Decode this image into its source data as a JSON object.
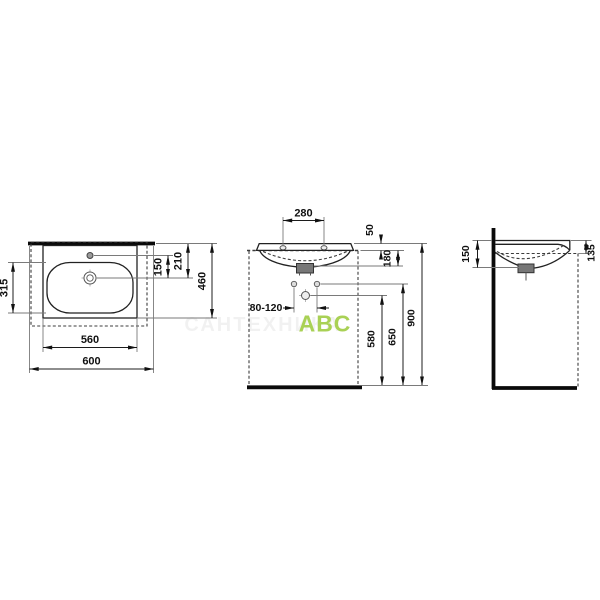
{
  "title": "washbasin-technical-drawing",
  "watermark": {
    "faint_text": "САНТЕХНИКА",
    "brand_text": "ABC",
    "brand_color": "#a9d155"
  },
  "views": {
    "top": {
      "name": "top-view",
      "dims": {
        "basin_depth": "315",
        "taphole_to_drain": "150",
        "rear_to_drain": "210",
        "overall_depth": "460",
        "inner_width": "560",
        "overall_width": "600"
      }
    },
    "front": {
      "name": "front-view",
      "dims": {
        "taphole_spacing": "280",
        "rim_offset": "50",
        "rim_to_outlet": "180",
        "supply_spacing": "80-120",
        "trap_height": "580",
        "outlet_height": "650",
        "overall_height": "900"
      }
    },
    "side": {
      "name": "side-view",
      "dims": {
        "front_depth_drop": "150",
        "rim_overhang": "135"
      }
    }
  }
}
